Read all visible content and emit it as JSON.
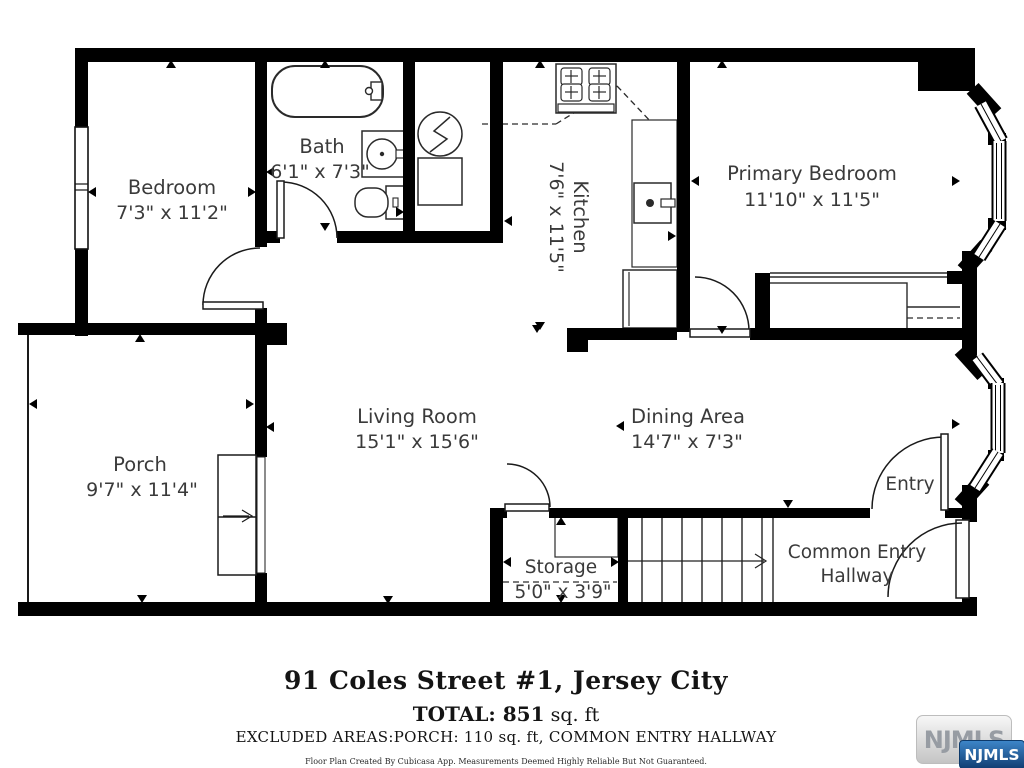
{
  "caption": {
    "title": "91 Coles Street #1, Jersey City",
    "total_bold": "TOTAL: 851",
    "total_rest": " sq. ft",
    "excluded": "EXCLUDED AREAS:PORCH:  110 sq. ft, COMMON ENTRY HALLWAY",
    "disclaimer": "Floor Plan Created By Cubicasa App. Measurements Deemed Highly Reliable But Not Guaranteed."
  },
  "logo": {
    "watermark_text": "NJMLS",
    "badge_text": "NJMLS",
    "badge_color": "#1d5fa7"
  },
  "rooms": {
    "bedroom": {
      "name": "Bedroom",
      "dims": "7'3\" x 11'2\""
    },
    "bath": {
      "name": "Bath",
      "dims": "6'1\" x 7'3\""
    },
    "kitchen": {
      "name": "Kitchen",
      "dims": "7'6\" x 11'5\""
    },
    "primary": {
      "name": "Primary Bedroom",
      "dims": "11'10\" x 11'5\""
    },
    "porch": {
      "name": "Porch",
      "dims": "9'7\" x 11'4\""
    },
    "living": {
      "name": "Living Room",
      "dims": "15'1\" x 15'6\""
    },
    "dining": {
      "name": "Dining Area",
      "dims": "14'7\" x 7'3\""
    },
    "entry": {
      "name": "Entry"
    },
    "storage": {
      "name": "Storage",
      "dims": "5'0\" x 3'9\""
    },
    "hallway": {
      "name_line1": "Common Entry",
      "name_line2": "Hallway"
    }
  }
}
